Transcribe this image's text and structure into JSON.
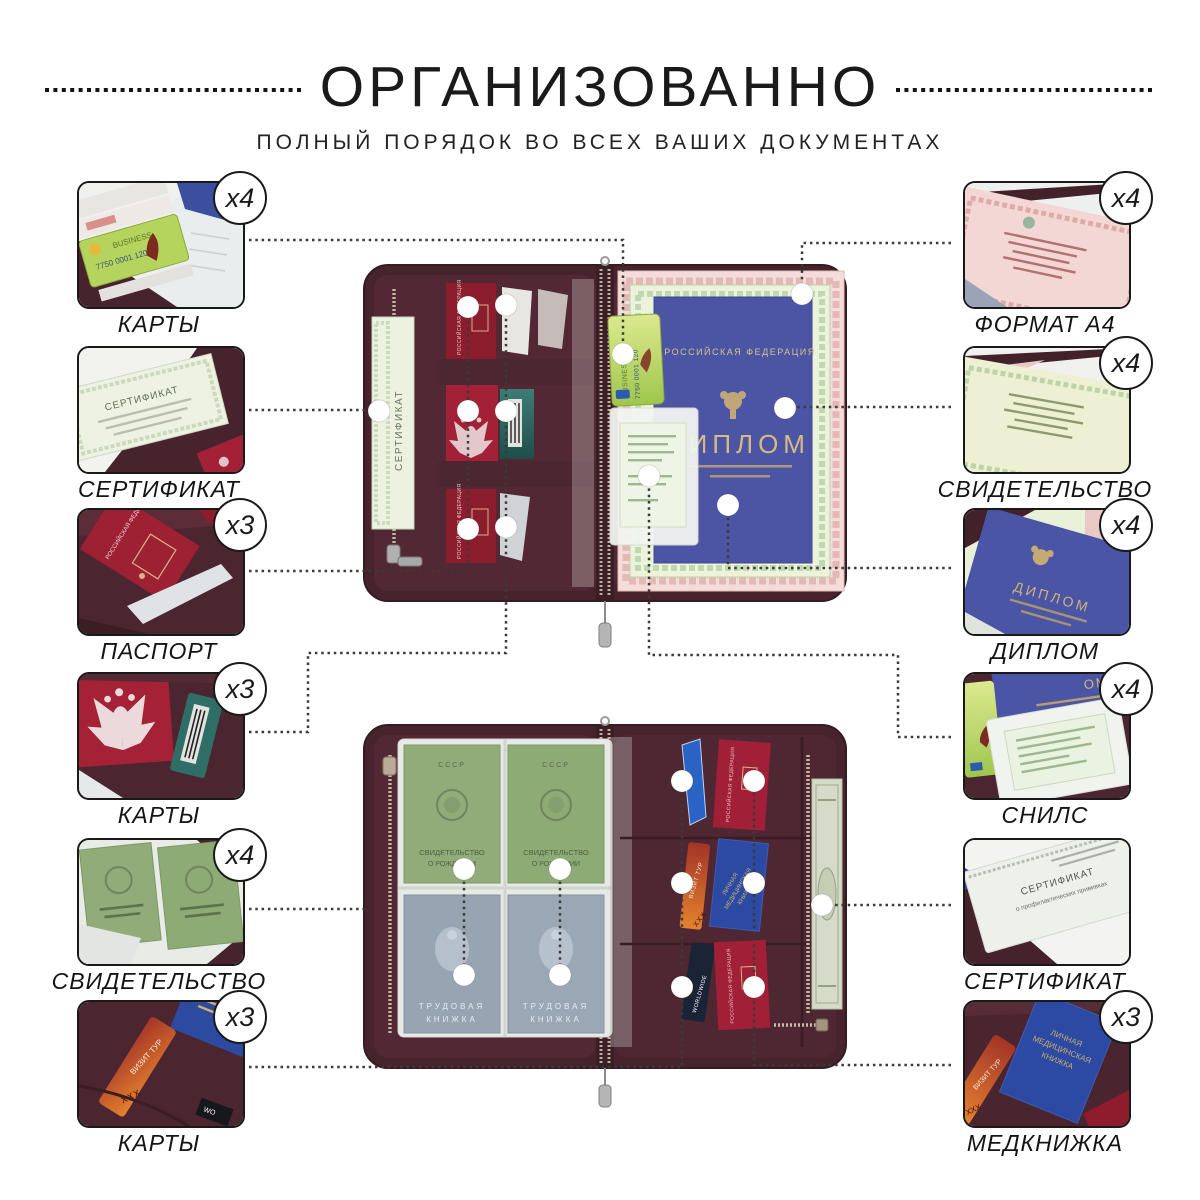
{
  "header": {
    "title": "ОРГАНИЗОВАННО",
    "subtitle": "ПОЛНЫЙ ПОРЯДОК ВО ВСЕХ ВАШИХ ДОКУМЕНТАХ"
  },
  "left_callouts": [
    {
      "label": "КАРТЫ",
      "badge": "x4"
    },
    {
      "label": "СЕРТИФИКАТ",
      "badge": null
    },
    {
      "label": "ПАСПОРТ",
      "badge": "x3"
    },
    {
      "label": "КАРТЫ",
      "badge": "x3"
    },
    {
      "label": "СВИДЕТЕЛЬСТВО",
      "badge": "x4"
    },
    {
      "label": "КАРТЫ",
      "badge": "x3"
    }
  ],
  "right_callouts": [
    {
      "label": "ФОРМАТ А4",
      "badge": "x4"
    },
    {
      "label": "СВИДЕТЕЛЬСТВО",
      "badge": "x4"
    },
    {
      "label": "ДИПЛОМ",
      "badge": "x4"
    },
    {
      "label": "СНИЛС",
      "badge": "x4"
    },
    {
      "label": "СЕРТИФИКАТ",
      "badge": null
    },
    {
      "label": "МЕДКНИЖКА",
      "badge": "x3"
    }
  ],
  "photo_texts": {
    "certificate": "СЕРТИФИКАТ",
    "cert_sub": "о профилактических прививках",
    "russian_federation": "РОССИЙСКАЯ ФЕДЕРАЦИЯ",
    "diploma": "ДИПЛОМ",
    "ussr": "СССР",
    "birth1": "СВИДЕТЕЛЬСТВО",
    "birth2": "О РОЖДЕНИИ",
    "work1": "ТРУДОВАЯ",
    "work2": "КНИЖКА",
    "med1": "ЛИЧНАЯ",
    "med2": "МЕДИЦИНСКАЯ",
    "med3": "КНИЖКА",
    "visit": "ВИЗИТ ТУР",
    "xxx": "XXX",
    "worldwide": "WORLDWIDE",
    "business": "BUSINESS",
    "card_number": "7750 0001 120"
  },
  "colors": {
    "leather": "#47232d",
    "leather_inner": "#512834",
    "passport_red": "#9e2033",
    "diploma_blue": "#4a55a4",
    "ussr_green": "#91ac79",
    "workbook_grey": "#97a5b2",
    "dotted_line": "#3a3a3a"
  }
}
